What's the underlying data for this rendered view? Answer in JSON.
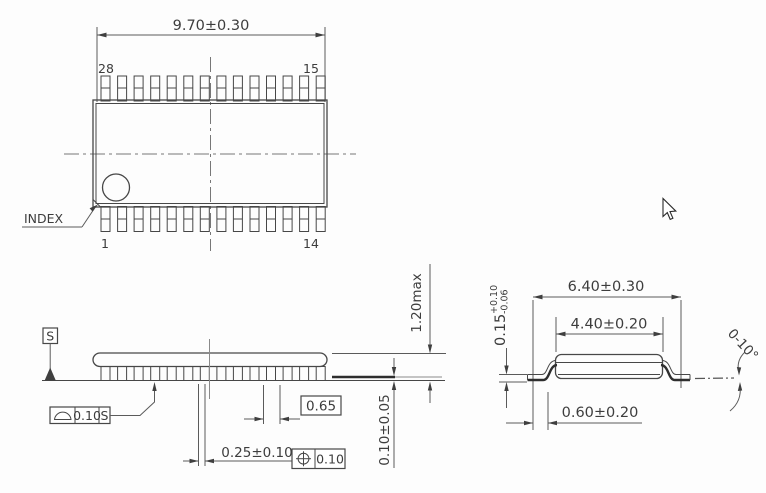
{
  "drawing_title": "28-pin package outline drawing",
  "colors": {
    "line": "#474747",
    "text": "#3d3d3d",
    "background": "#fdfdfd"
  },
  "top_view": {
    "width_dim": "9.70±0.30",
    "pin_top_left": "28",
    "pin_top_right": "15",
    "pin_bottom_left": "1",
    "pin_bottom_right": "14",
    "index_label": "INDEX"
  },
  "side_view": {
    "datum_label": "S",
    "coplanarity_symbol": "seating-plane-dome",
    "coplanarity_tolerance": "0.10",
    "coplanarity_datum": "S",
    "pitch_dim": "0.65",
    "lead_width_dim": "0.25±0.10",
    "position_symbol": "true-position-crosshair",
    "position_tolerance": "0.10",
    "height_dim": "1.20max",
    "standoff_dim": "0.10±0.05"
  },
  "end_view": {
    "total_width_dim": "6.40±0.30",
    "body_width_dim": "4.40±0.20",
    "lead_thickness_value": "0.15",
    "lead_thickness_plus": "+0.10",
    "lead_thickness_minus": "-0.06",
    "foot_length_dim": "0.60±0.20",
    "lead_angle_dim": "0-10°"
  }
}
